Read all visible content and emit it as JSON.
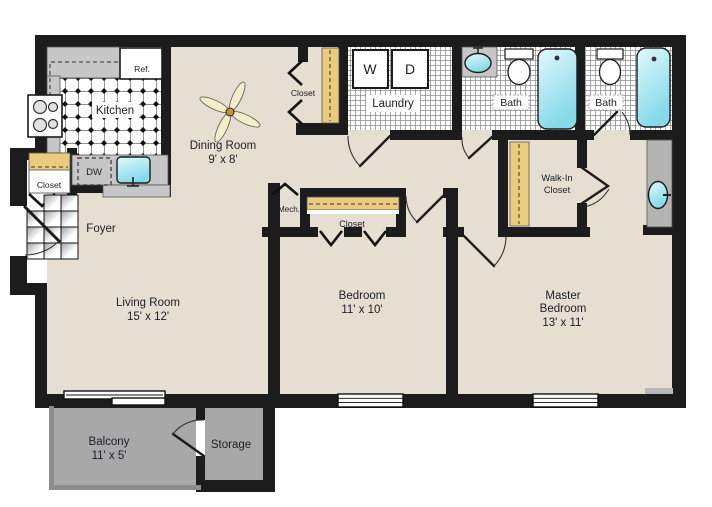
{
  "plan_title": "Two bedroom apartment floor plan",
  "rooms": {
    "kitchen": {
      "label": "Kitchen"
    },
    "dining": {
      "label": "Dining Room",
      "dims": "9' x 8'"
    },
    "living": {
      "label": "Living Room",
      "dims": "15' x 12'"
    },
    "foyer": {
      "label": "Foyer"
    },
    "laundry": {
      "label": "Laundry"
    },
    "bath1": {
      "label": "Bath"
    },
    "bath2": {
      "label": "Bath"
    },
    "walkin": {
      "label1": "Walk-In",
      "label2": "Closet"
    },
    "mech": {
      "label": "Mech."
    },
    "bedroom": {
      "label": "Bedroom",
      "dims": "11' x 10'"
    },
    "master": {
      "label1": "Master",
      "label2": "Bedroom",
      "dims": "13' x 11'"
    },
    "balcony": {
      "label": "Balcony",
      "dims": "11' x 5'"
    },
    "storage": {
      "label": "Storage"
    }
  },
  "closets": {
    "dining_closet": {
      "label": "Closet"
    },
    "foyer_closet": {
      "label": "Closet"
    },
    "bedroom_closet": {
      "label": "Closet"
    }
  },
  "fixtures": {
    "washer": "W",
    "dryer": "D",
    "refrigerator": "Ref.",
    "dishwasher": "DW"
  },
  "colors": {
    "floor": "#e6dfd1",
    "wall": "#1c1c1c",
    "shelf_tan": "#eacb7e",
    "counter_gray": "#c6c6c6",
    "patio_gray": "#a8a8a8",
    "fixture_cyan": "#8edcec",
    "text": "#20202a"
  }
}
